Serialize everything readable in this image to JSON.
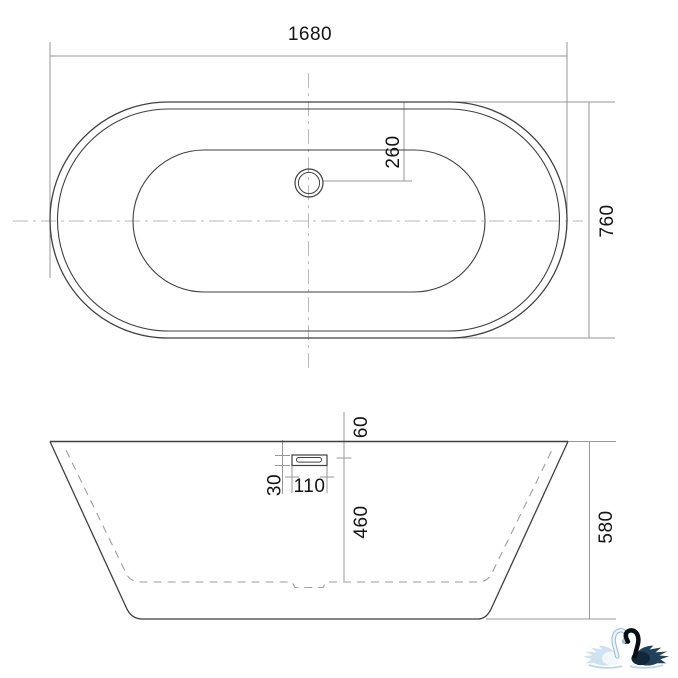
{
  "drawing": {
    "background_color": "#ffffff",
    "line_color": "#3f3f3f",
    "dimension_line_color": "#979797",
    "centerline_color": "#b9b9b9",
    "inner_dashed_color": "#9e9e9e",
    "text_color": "#141414",
    "top_view": {
      "length": "1680",
      "width": "760",
      "drain_offset": "260"
    },
    "side_view": {
      "rim_to_overflow": "60",
      "overflow_height": "30",
      "overflow_width": "110",
      "inner_depth": "460",
      "overall_height": "580"
    },
    "logo": {
      "icon": "two-swans-heart-logo",
      "light_swan_color": "#cfe2ef",
      "light_swan_shade": "#9bbdd4",
      "dark_swan_color": "#20405c",
      "dark_swan_deep": "#122739",
      "neck_black": "#0a0d12",
      "splash_color": "#bdd7e8"
    }
  }
}
